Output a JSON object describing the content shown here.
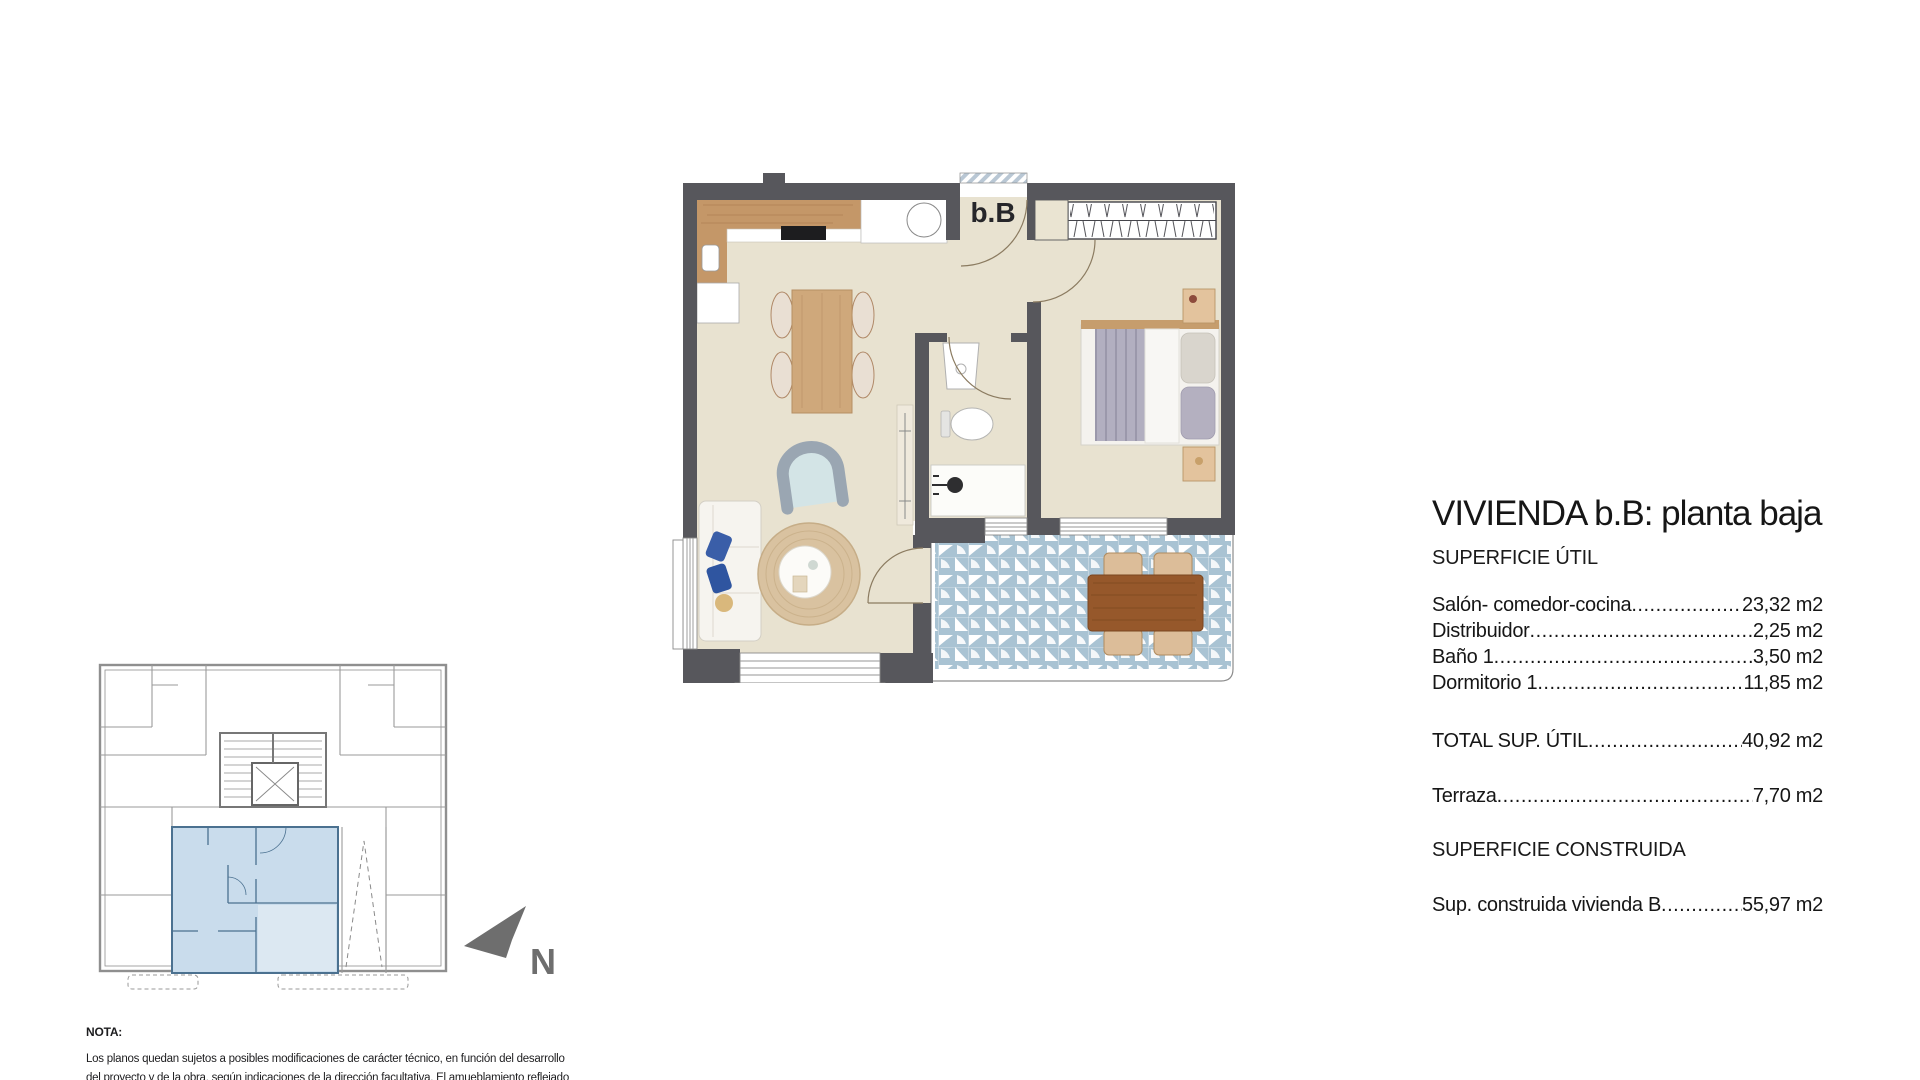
{
  "header": {
    "title": "VIVIENDA b.B: planta baja"
  },
  "specs": {
    "leader": "..................................................................................................................................",
    "superficie_util_heading": "SUPERFICIE ÚTIL",
    "rows": [
      {
        "label": "Salón- comedor-cocina",
        "value": "23,32 m2"
      },
      {
        "label": "Distribuidor",
        "value": "2,25 m2"
      },
      {
        "label": "Baño 1",
        "value": "3,50 m2"
      },
      {
        "label": "Dormitorio 1",
        "value": "11,85 m2"
      }
    ],
    "total_row": {
      "label": "TOTAL SUP. ÚTIL",
      "value": "40,92 m2"
    },
    "terraza_row": {
      "label": "Terraza",
      "value": "7,70 m2"
    },
    "superficie_construida_heading": "SUPERFICIE CONSTRUIDA",
    "construida_row": {
      "label": "Sup. construida vivienda B",
      "value": "55,97 m2"
    }
  },
  "plan": {
    "unit_label": "b.B",
    "colors": {
      "wall": "#57575c",
      "floor": "#e8e2d0",
      "terrace_tile": "#a9c3d3",
      "wood": "#c49768",
      "kp_fill": "#c9dcec",
      "kp_stroke": "#4b7190",
      "north": "#6e6e6e"
    }
  },
  "north": {
    "label": "N"
  },
  "note": {
    "heading": "NOTA:",
    "line1": "Los planos quedan sujetos a posibles modificaciones de carácter técnico, en función del desarrollo",
    "line2": "del proyecto y de la obra, según indicaciones de la dirección facultativa. El amueblamiento reflejado"
  }
}
